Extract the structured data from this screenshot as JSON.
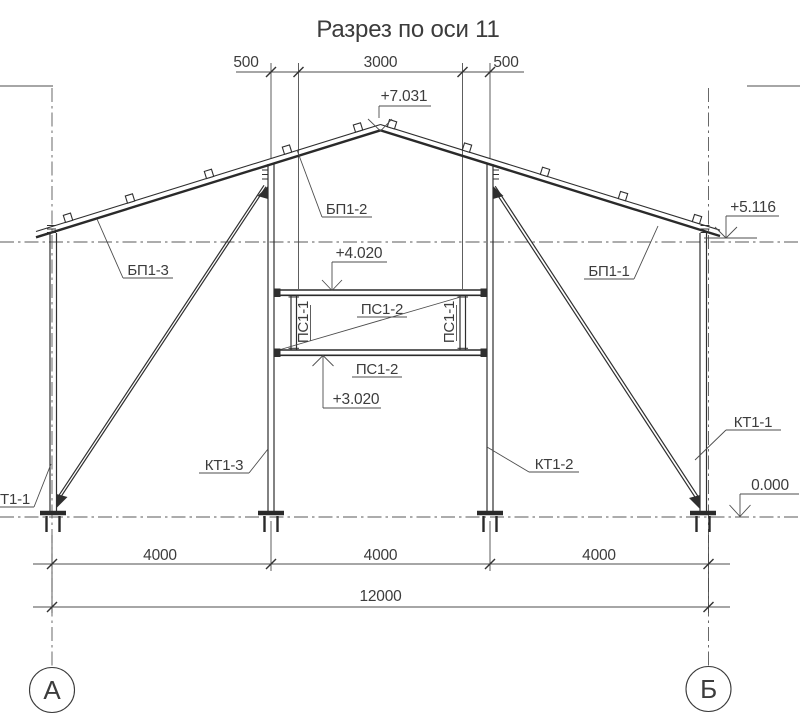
{
  "title": "Разрез по оси 11",
  "top_dims": {
    "left": "500",
    "middle": "3000",
    "right": "500"
  },
  "elevations": {
    "apex": "+7.031",
    "eave_right": "+5.116",
    "mezzanine_top": "+4.020",
    "mezzanine_bottom": "+3.020",
    "ground": "0.000"
  },
  "member_labels": {
    "roof_beam_apex_left": "БП1-2",
    "roof_beam_left": "БП1-3",
    "roof_beam_right": "БП1-1",
    "mezzanine_beam_top": "ПС1-2",
    "mezzanine_beam_bottom": "ПС1-2",
    "mezzanine_post_left": "ПС1-1",
    "mezzanine_post_right": "ПС1-1",
    "column_inner_left": "КТ1-3",
    "column_inner_right": "КТ1-2",
    "column_outer_right": "КТ1-1",
    "column_outer_left_partial": "Т1-1"
  },
  "bottom_dims": {
    "spans": [
      "4000",
      "4000",
      "4000"
    ],
    "total": "12000"
  },
  "axis_markers": {
    "left": "А",
    "right": "Б"
  }
}
